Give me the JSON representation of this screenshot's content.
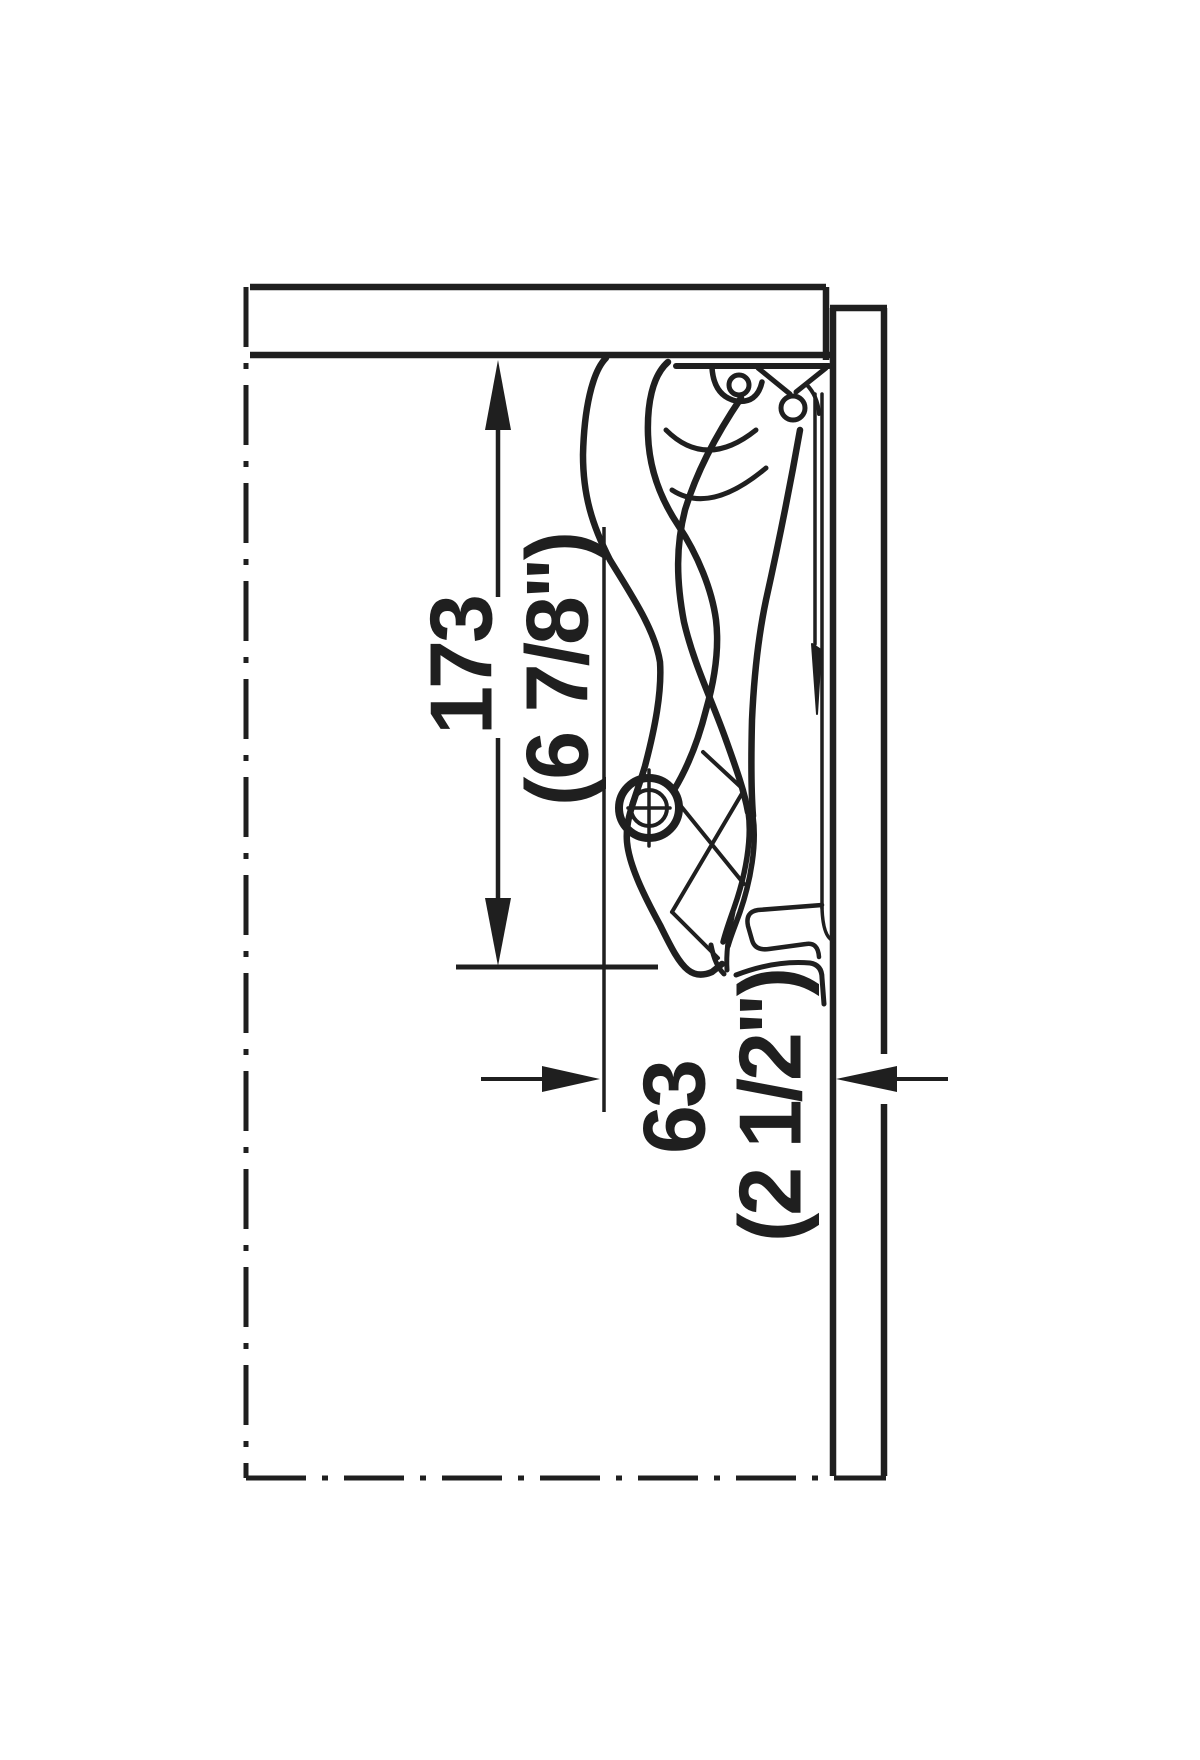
{
  "page": {
    "background": "#ffffff",
    "width_px": 1200,
    "height_px": 1760
  },
  "drawing": {
    "kind": "cabinet-flap-lift-fitting-side-section",
    "line_color": "#1f1f1f",
    "dimensions": {
      "height": {
        "mm": "173",
        "inches": "(6 7/8\")"
      },
      "depth": {
        "mm": "63",
        "inches": "(2 1/2\")"
      }
    }
  }
}
